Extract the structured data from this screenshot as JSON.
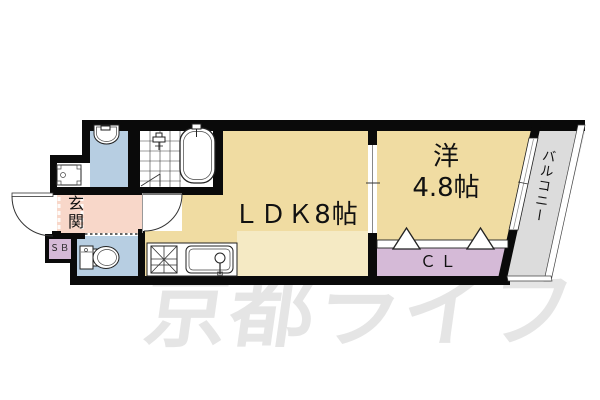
{
  "plan": {
    "type": "apartment-floor-plan",
    "rooms": {
      "ldk": {
        "label": "ＬＤＫ8帖"
      },
      "western": {
        "line1": "洋",
        "line2": "4.8帖"
      },
      "closet": {
        "label": "ＣＬ"
      },
      "entrance": {
        "label": "玄関"
      },
      "shoebox": {
        "label": "ＳＢ"
      },
      "balcony": {
        "label": "バルコニー"
      }
    },
    "fixtures": [
      "washbasin",
      "washing-machine",
      "bathtub",
      "shower-mixer",
      "toilet",
      "gas-stove",
      "kitchen-sink",
      "entrance-door",
      "hall-door",
      "sliding-door",
      "closet-doors",
      "window",
      "balcony-railing"
    ],
    "watermark": {
      "text": "京都ライフ"
    },
    "colors": {
      "floor": "#F0DCA2",
      "floor-light": "#F5EAC4",
      "wet": "#B7CEE2",
      "hall": "#F8D7C9",
      "closet": "#D5BAD7",
      "balcony": "#DCDCDC",
      "wall": "#0A0A0A",
      "watermark": "#E5E5E5"
    }
  }
}
